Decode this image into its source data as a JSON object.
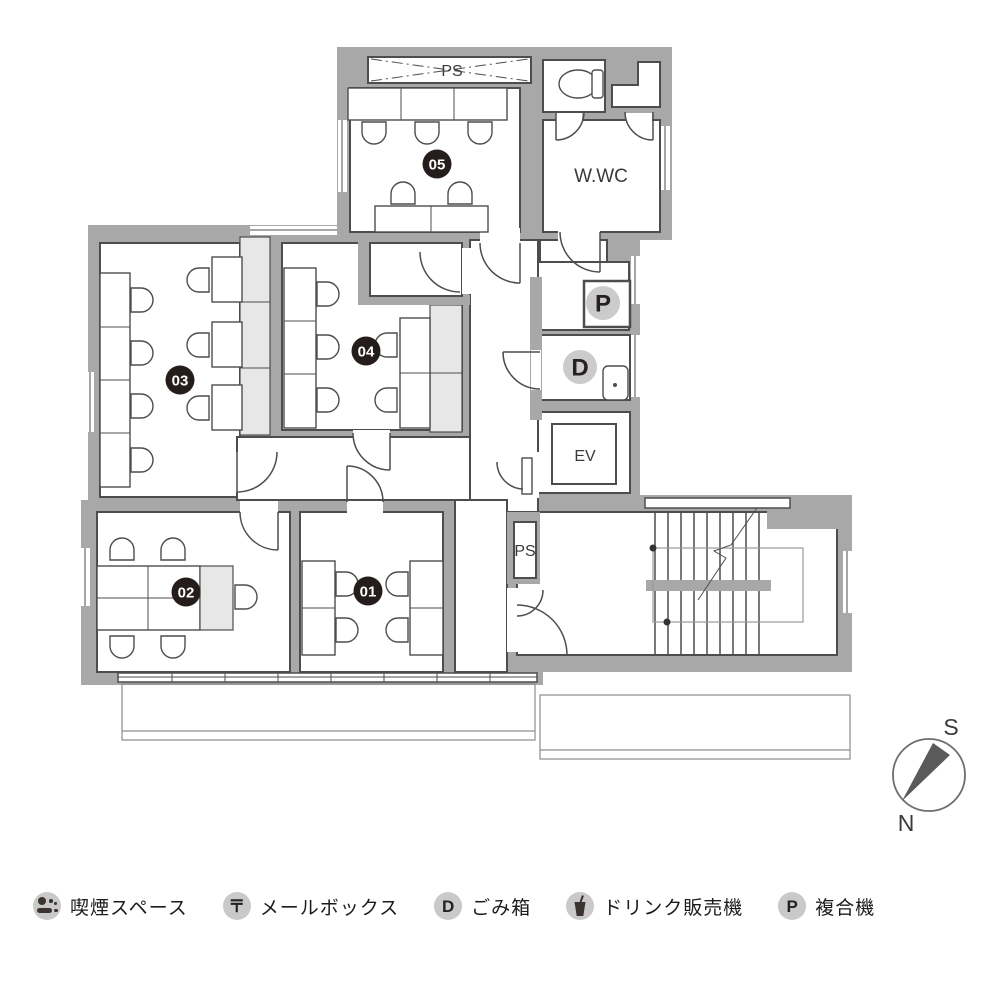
{
  "plan": {
    "ps_duct_label": "PS",
    "wwc_label": "W.WC",
    "ev_label": "EV",
    "ps_shaft_label": "PS",
    "printer_label": "P",
    "trash_label": "D",
    "rooms": {
      "r01": "01",
      "r02": "02",
      "r03": "03",
      "r04": "04",
      "r05": "05"
    }
  },
  "compass": {
    "south": "S",
    "north": "N"
  },
  "legend": {
    "items": [
      {
        "name": "smoking",
        "glyph": "",
        "label": "喫煙スペース"
      },
      {
        "name": "mailbox",
        "glyph": "〒",
        "label": "メールボックス"
      },
      {
        "name": "trash",
        "glyph": "D",
        "label": "ごみ箱"
      },
      {
        "name": "vending",
        "glyph": "",
        "label": "ドリンク販売機"
      },
      {
        "name": "printer",
        "glyph": "P",
        "label": "複合機"
      }
    ]
  },
  "colors": {
    "wall": "#a8a8a8",
    "line": "#4d4d4d",
    "cabinet": "#e7e7e7",
    "room_badge": "#241d1b",
    "gray_badge": "#cbcbcb"
  }
}
